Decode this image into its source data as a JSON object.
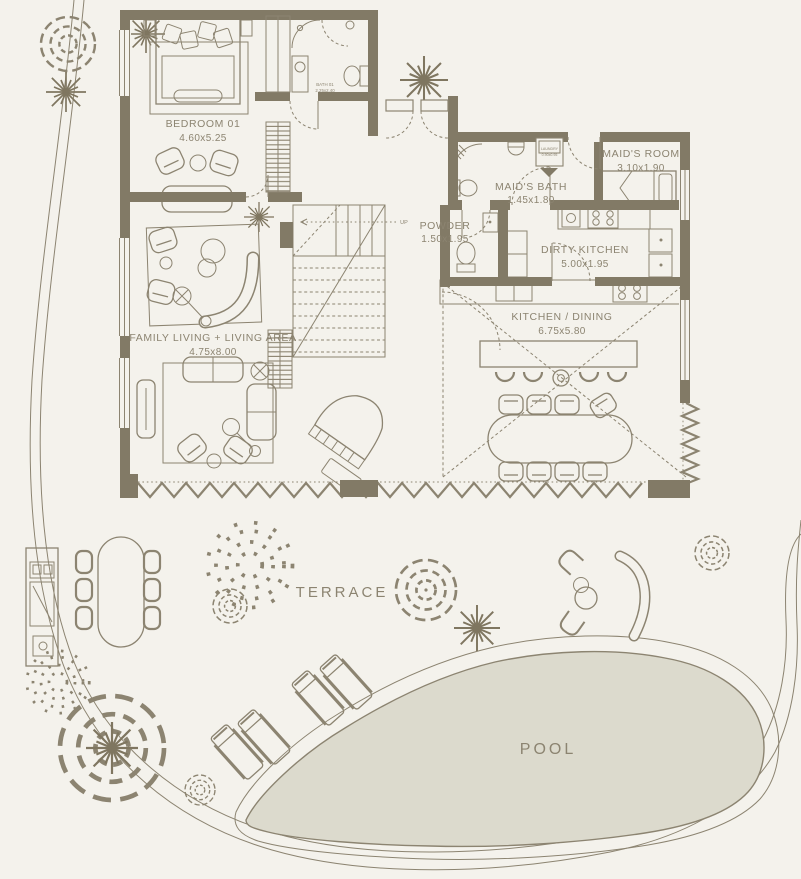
{
  "colors": {
    "background": "#f4f2ec",
    "walls": "#827a66",
    "lines": "#8c8471",
    "pool_fill": "#dcdacd",
    "text": "#8c8471"
  },
  "rooms": {
    "bedroom01": {
      "name": "BEDROOM 01",
      "dims": "4.60x5.25"
    },
    "bath01": {
      "name": "BATH 01",
      "dims": "2.25x2.40"
    },
    "laundry": {
      "name": "LAUNDRY",
      "dims": "0.90x0.95"
    },
    "maids_bath": {
      "name": "MAID'S BATH",
      "dims": "1.45x1.80"
    },
    "maids_room": {
      "name": "MAID'S ROOM",
      "dims": "3.10x1.90"
    },
    "powder": {
      "name": "POWDER",
      "dims": "1.50x1.95"
    },
    "dirty_kitchen": {
      "name": "DIRTY KITCHEN",
      "dims": "5.00x1.95"
    },
    "kitchen_dining": {
      "name": "KITCHEN / DINING",
      "dims": "6.75x5.80"
    },
    "family_living": {
      "name": "FAMILY LIVING + LIVING AREA",
      "dims": "4.75x8.00"
    },
    "terrace": {
      "name": "TERRACE"
    },
    "pool": {
      "name": "POOL"
    }
  },
  "stairs": {
    "direction_label": "UP"
  }
}
